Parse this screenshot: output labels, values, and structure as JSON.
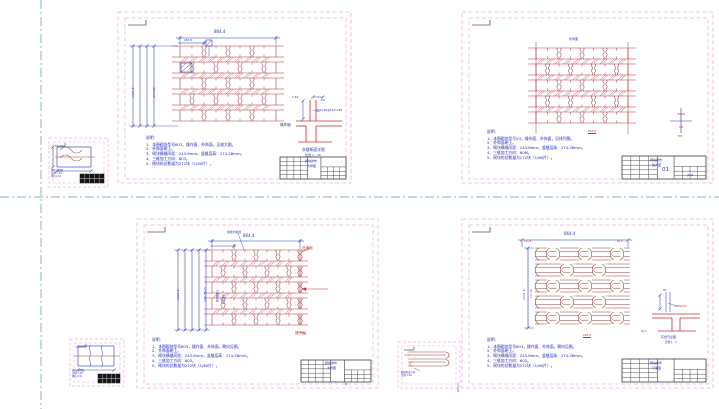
{
  "canvas": {
    "width": 719,
    "height": 409
  },
  "colors": {
    "paper": "#ffffff",
    "sheet_border_pink": "#efaede",
    "line_maroon": "#96403c",
    "line_red": "#c23030",
    "dim_blue": "#2433b8",
    "note_blue": "#2226bb",
    "teal_guide": "#7eb4c4",
    "title_block_gray": "#3c3c3c"
  },
  "stamp": "603-v3",
  "sheets": {
    "tl": {
      "dims": {
        "top": "864.4",
        "top_small": "243.6",
        "left_total": "1371.9",
        "left_course": "274.38",
        "detail_h": "1.84",
        "detail_w": "60"
      },
      "labels": {
        "face": "操作面",
        "rebar": "2Φ6+Φ4@512=2Φ5",
        "detail_caption": "灰缝断面详图",
        "detail_scale": "比例  1：20"
      },
      "notes": {
        "title": "说明：",
        "items": [
          "1、本图砌块型号603，操作面、外饰面，见放大图。",
          "2、外饰面朝上。",
          "3、砌块横缝间距：243.6mm，竖缝层高：274.38mm。",
          "4、三维加工方向：603。",
          "5、砌块的总数量为272块（1/60片）。"
        ]
      },
      "titleblock": {
        "line1": "砌块排布",
        "line2": "大样图"
      }
    },
    "tr": {
      "labels": {
        "top": "外饰面",
        "bottom_red": "243.6",
        "marker": "M5"
      },
      "notes": {
        "title": "说明：",
        "items": [
          "1、本图砌块型号V3，操作面、外饰面，见排列图。",
          "2、外饰面朝上。",
          "3、砌块横缝间距：243.6mm，竖缝层高：274.38mm。",
          "4、三维加工方向：60M。",
          "5、砌块的总数量为272块（1/60片）。"
        ]
      },
      "titleblock": {
        "line1": "砌块排布",
        "line2": "放大图",
        "sheet_no": "01",
        "doc_no": "JS-01"
      }
    },
    "bl": {
      "dims": {
        "top": "864.4",
        "left_total": "1371.9",
        "left_course": "274.38×5",
        "inner_note": "操作面朝上",
        "inner_note2": "砂浆填实"
      },
      "labels": {
        "leader_top": "填缝剂勾缝",
        "wall_face": "外墙面",
        "work_face": "操作面"
      },
      "notes": {
        "title": "说明：",
        "items": [
          "1、本图砌块型号603，操作面、外饰面，朝向见图。",
          "2、外饰面朝上。",
          "3、砌块横缝间距：243.6mm，竖缝层高：274.38mm。",
          "4、三维加工方向：603。",
          "5、砌块的总数量为272块（1/60片）。"
        ]
      },
      "titleblock": {
        "line1": "砌块排布",
        "line2": "大样图"
      }
    },
    "br": {
      "dims": {
        "top": "864.4",
        "top_left_red": "121.8",
        "top_right_red": "60.9",
        "left_total": "1371.9",
        "left_course": "274.38",
        "bottom_red1": "243.6",
        "bottom_red2": "60.9"
      },
      "labels": {
        "rebar": "2Φ6@512",
        "detail_dim": "60",
        "detail_caption": "灰缝节点图",
        "detail_scale": "比例 1：5"
      },
      "notes": {
        "title": "说明：",
        "items": [
          "1、本图砌块型号603，操作面、外饰面，朝向见图。",
          "2、外饰面朝上。",
          "3、砌块横缝间距：243.6mm，竖缝层高：274.38mm。",
          "4、三维加工方向：603。",
          "5、砌块的总数量为272块（1/60片）。"
        ]
      },
      "titleblock": {
        "line1": "砌块排布",
        "line2": "平面图"
      }
    }
  },
  "minis": [
    {
      "lines": [
        "砌块大样图",
        "比例 1:10",
        "单位:mm"
      ]
    },
    {
      "lines": [
        "砌块大样图",
        "比例 1:10",
        "单位:mm"
      ]
    },
    {
      "lines": [
        "砌块断面大样",
        "比例 1:10"
      ]
    }
  ]
}
